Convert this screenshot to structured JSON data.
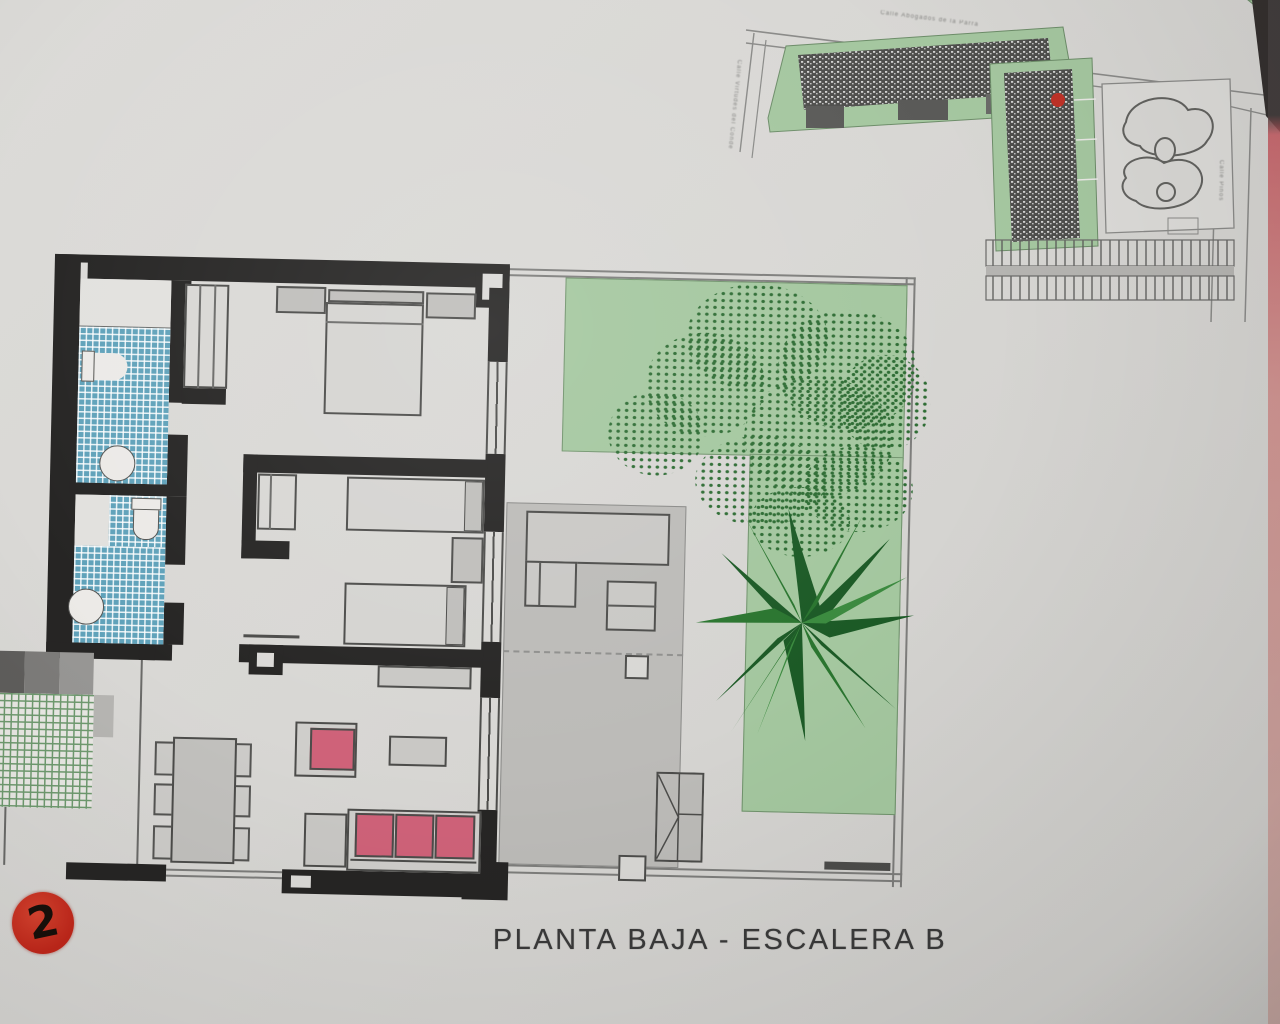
{
  "title": "PLANTA BAJA - ESCALERA B",
  "unit_badge": "2",
  "site_plan": {
    "street_top": "Calle Abogados de la Parra",
    "street_left": "Calle Virtudes del Conde",
    "street_right": "Calle Pinos",
    "marker_color": "#c03228"
  },
  "colors": {
    "badge_red": "#c1271a",
    "bathroom_tile_blue": "#60a2ba",
    "porch_tile_green": "#6f9a6f",
    "lawn_green": "#a4c79f",
    "plant_dark_green": "#1c5a26",
    "sofa_pink": "#cf6279",
    "wall_black": "#262524",
    "paper_gray": "#d8d7d4"
  }
}
